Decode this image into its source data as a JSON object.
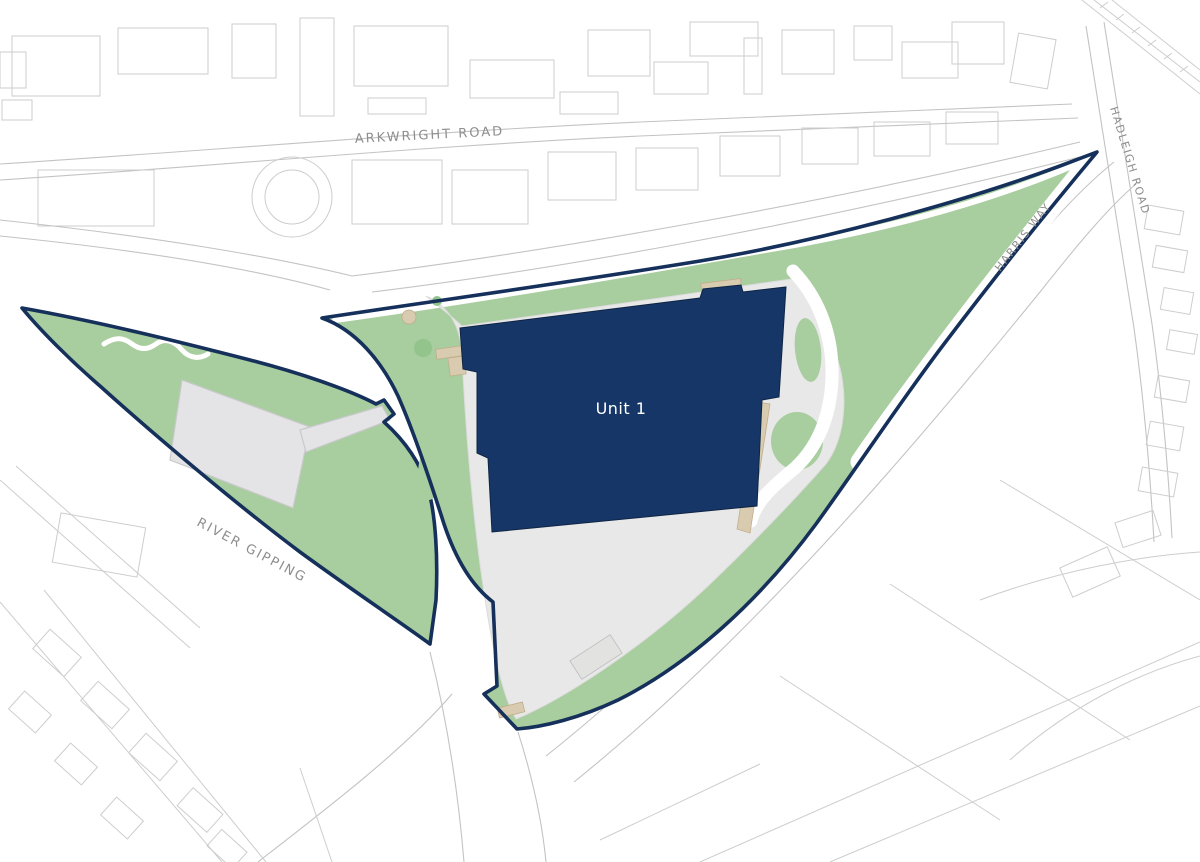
{
  "map": {
    "type": "site-plan",
    "labels": {
      "unit1": "Unit 1",
      "arkwright_road": "ARKWRIGHT ROAD",
      "hadleigh_road": "HADLEIGH ROAD",
      "harris_way": "HARRIS WAY",
      "river_gipping": "RIVER GIPPING"
    }
  },
  "colors": {
    "background": "#ffffff",
    "site_boundary": "#15305a",
    "unit_fill": "#173668",
    "unit_text": "#ffffff",
    "landscape_green": "#a8cd9e",
    "tree_green": "#93c48c",
    "yard_grey": "#e8e8e8",
    "existing_building_grey": "#e4e4e6",
    "dock_tan": "#d8cbb0",
    "context_line_grey": "#cdcdcd",
    "road_label_grey": "#8e8e8e"
  }
}
